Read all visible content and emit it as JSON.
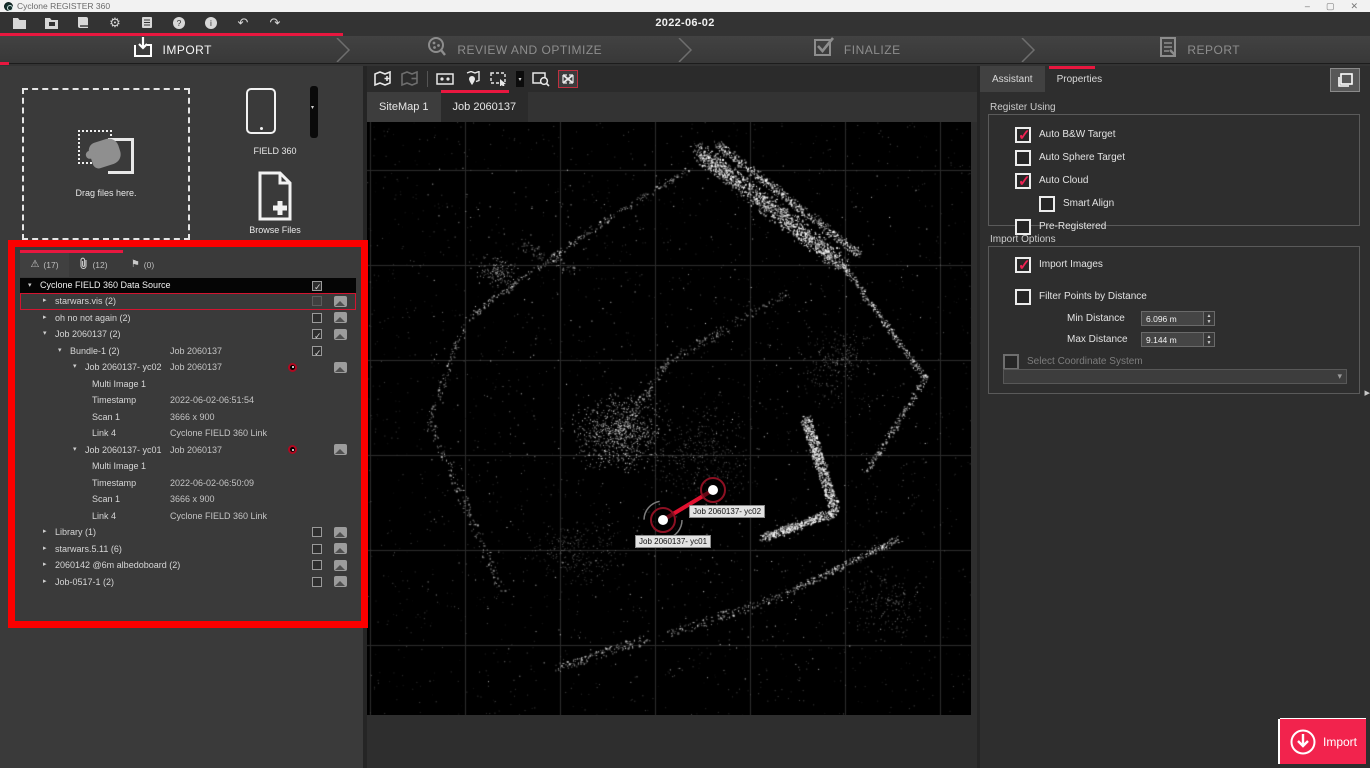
{
  "window": {
    "title": "Cyclone REGISTER 360",
    "controls": {
      "minimize": "–",
      "maximize": "▢",
      "close": "✕"
    }
  },
  "menubar": {
    "date": "2022-06-02",
    "tools": [
      "open-folder-icon",
      "project-save-icon",
      "book-icon",
      "settings-gear-icon",
      "database-list-icon",
      "help-icon",
      "info-icon",
      "undo-icon",
      "redo-icon"
    ]
  },
  "workflow": {
    "stages": [
      {
        "label": "IMPORT",
        "icon": "import-download-icon",
        "active": true
      },
      {
        "label": "REVIEW AND OPTIMIZE",
        "icon": "review-magnifier-icon",
        "active": false
      },
      {
        "label": "FINALIZE",
        "icon": "finalize-checkbox-icon",
        "active": false
      },
      {
        "label": "REPORT",
        "icon": "report-document-icon",
        "active": false
      }
    ]
  },
  "import_panel": {
    "drag_label": "Drag files here.",
    "field360_label": "FIELD 360",
    "browse_label": "Browse Files"
  },
  "tree": {
    "tabs": [
      {
        "icon": "warning-triangle-icon",
        "glyph": "⚠",
        "count": "(17)",
        "active": true
      },
      {
        "icon": "paperclip-icon",
        "glyph": "",
        "count": "(12)",
        "active": false
      },
      {
        "icon": "flag-icon",
        "glyph": "⚑",
        "count": "(0)",
        "active": false
      }
    ],
    "rows": [
      {
        "level": 0,
        "arrow": "expanded",
        "label": "Cyclone FIELD 360 Data Source",
        "value": "",
        "check": "checked",
        "image": false,
        "dot": false,
        "header": true
      },
      {
        "level": 1,
        "arrow": "collapsed",
        "label": "starwars.vis (2)",
        "value": "",
        "check": "dim",
        "image": true,
        "dot": false,
        "outlined": true
      },
      {
        "level": 1,
        "arrow": "collapsed",
        "label": "oh no not again (2)",
        "value": "",
        "check": "unchecked",
        "image": true,
        "dot": false
      },
      {
        "level": 1,
        "arrow": "expanded",
        "label": "Job 2060137 (2)",
        "value": "",
        "check": "checked",
        "image": true,
        "dot": false
      },
      {
        "level": 2,
        "arrow": "expanded",
        "label": "Bundle-1 (2)",
        "value": "Job 2060137",
        "check": "checked",
        "image": false,
        "dot": false
      },
      {
        "level": 3,
        "arrow": "expanded",
        "label": "Job 2060137- yc02",
        "value": "Job 2060137",
        "check": "none",
        "image": true,
        "dot": true
      },
      {
        "level": 4,
        "arrow": "none",
        "label": "Multi Image 1",
        "value": "",
        "check": "none",
        "image": false,
        "dot": false
      },
      {
        "level": 4,
        "arrow": "none",
        "label": "Timestamp",
        "value": "2022-06-02-06:51:54",
        "check": "none",
        "image": false,
        "dot": false
      },
      {
        "level": 4,
        "arrow": "none",
        "label": "Scan 1",
        "value": "3666 x 900",
        "check": "none",
        "image": false,
        "dot": false
      },
      {
        "level": 4,
        "arrow": "none",
        "label": "Link 4",
        "value": "Cyclone FIELD 360 Link",
        "check": "none",
        "image": false,
        "dot": false
      },
      {
        "level": 3,
        "arrow": "expanded",
        "label": "Job 2060137- yc01",
        "value": "Job 2060137",
        "check": "none",
        "image": true,
        "dot": true
      },
      {
        "level": 4,
        "arrow": "none",
        "label": "Multi Image 1",
        "value": "",
        "check": "none",
        "image": false,
        "dot": false
      },
      {
        "level": 4,
        "arrow": "none",
        "label": "Timestamp",
        "value": "2022-06-02-06:50:09",
        "check": "none",
        "image": false,
        "dot": false
      },
      {
        "level": 4,
        "arrow": "none",
        "label": "Scan 1",
        "value": "3666 x 900",
        "check": "none",
        "image": false,
        "dot": false
      },
      {
        "level": 4,
        "arrow": "none",
        "label": "Link 4",
        "value": "Cyclone FIELD 360 Link",
        "check": "none",
        "image": false,
        "dot": false
      },
      {
        "level": 1,
        "arrow": "collapsed",
        "label": "Library (1)",
        "value": "",
        "check": "unchecked",
        "image": true,
        "dot": false
      },
      {
        "level": 1,
        "arrow": "collapsed",
        "label": "starwars.5.11 (6)",
        "value": "",
        "check": "unchecked",
        "image": true,
        "dot": false
      },
      {
        "level": 1,
        "arrow": "collapsed",
        "label": "2060142 @6m albedoboard  (2)",
        "value": "",
        "check": "unchecked",
        "image": true,
        "dot": false
      },
      {
        "level": 1,
        "arrow": "collapsed",
        "label": "Job-0517-1 (2)",
        "value": "",
        "check": "unchecked",
        "image": true,
        "dot": false
      }
    ]
  },
  "viewport": {
    "toolbar_icons": [
      "map-add-icon",
      "map-remove-icon",
      "image-link-icon",
      "map-pin-icon",
      "rect-select-icon",
      "select-dropdown-caret",
      "image-zoom-icon",
      "move-arrows-icon"
    ],
    "tabs": [
      {
        "label": "SiteMap 1",
        "active": false
      },
      {
        "label": "Job 2060137",
        "active": true
      }
    ],
    "nodes": [
      {
        "label": "Job 2060137- yc02",
        "x": 346,
        "y": 368
      },
      {
        "label": "Job 2060137- yc01",
        "x": 296,
        "y": 398
      }
    ]
  },
  "right_panel": {
    "tabs": [
      {
        "label": "Assistant",
        "active": true
      },
      {
        "label": "Properties",
        "active": false
      }
    ],
    "register_using": {
      "title": "Register Using",
      "options": [
        {
          "label": "Auto B&W Target",
          "checked": true,
          "indent": false
        },
        {
          "label": "Auto Sphere Target",
          "checked": false,
          "indent": false
        },
        {
          "label": "Auto Cloud",
          "checked": true,
          "indent": false
        },
        {
          "label": "Smart Align",
          "checked": false,
          "indent": true
        },
        {
          "label": "Pre-Registered",
          "checked": false,
          "indent": false
        }
      ]
    },
    "import_options": {
      "title": "Import Options",
      "import_images": {
        "label": "Import Images",
        "checked": true
      },
      "filter_points": {
        "label": "Filter Points by Distance",
        "checked": false
      },
      "min_distance": {
        "label": "Min Distance",
        "value": "6.096 m"
      },
      "max_distance": {
        "label": "Max Distance",
        "value": "9.144 m"
      },
      "coordinate_system": {
        "label": "Select Coordinate System",
        "checked": false,
        "disabled": true
      }
    }
  },
  "import_button": {
    "label": "Import"
  },
  "colors": {
    "accent_red": "#e8173f",
    "button_red": "#f2234d",
    "annotation_red": "#fb0000",
    "check_red": "#ee2152",
    "node_ring": "#8c1022"
  }
}
